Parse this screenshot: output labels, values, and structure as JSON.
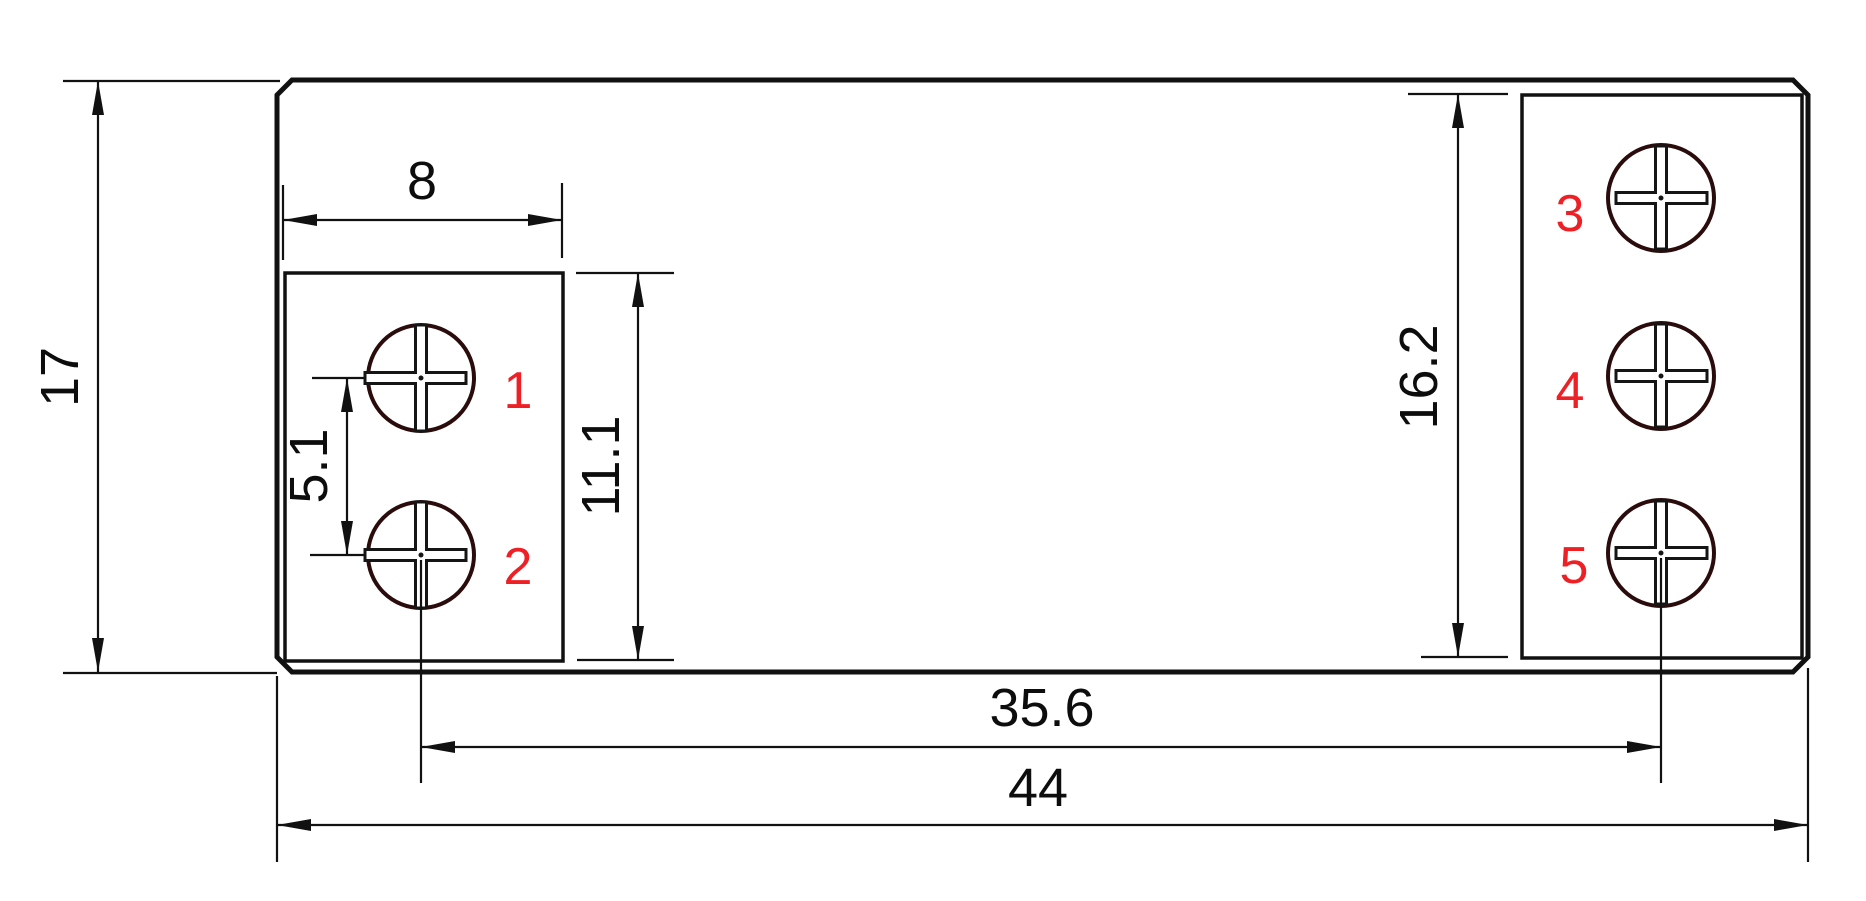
{
  "dimensions": {
    "overall_height": "17",
    "overall_width": "44",
    "left_block_width": "8",
    "left_block_height": "11.1",
    "terminal_pitch": "5.1",
    "right_block_height": "16.2",
    "terminal_span": "35.6"
  },
  "terminal_labels": [
    "1",
    "2",
    "3",
    "4",
    "5"
  ],
  "colors": {
    "line": "#111111",
    "screw_outline": "#2b0c0c",
    "terminal_label_red": "#ee2026",
    "background": "#ffffff"
  }
}
